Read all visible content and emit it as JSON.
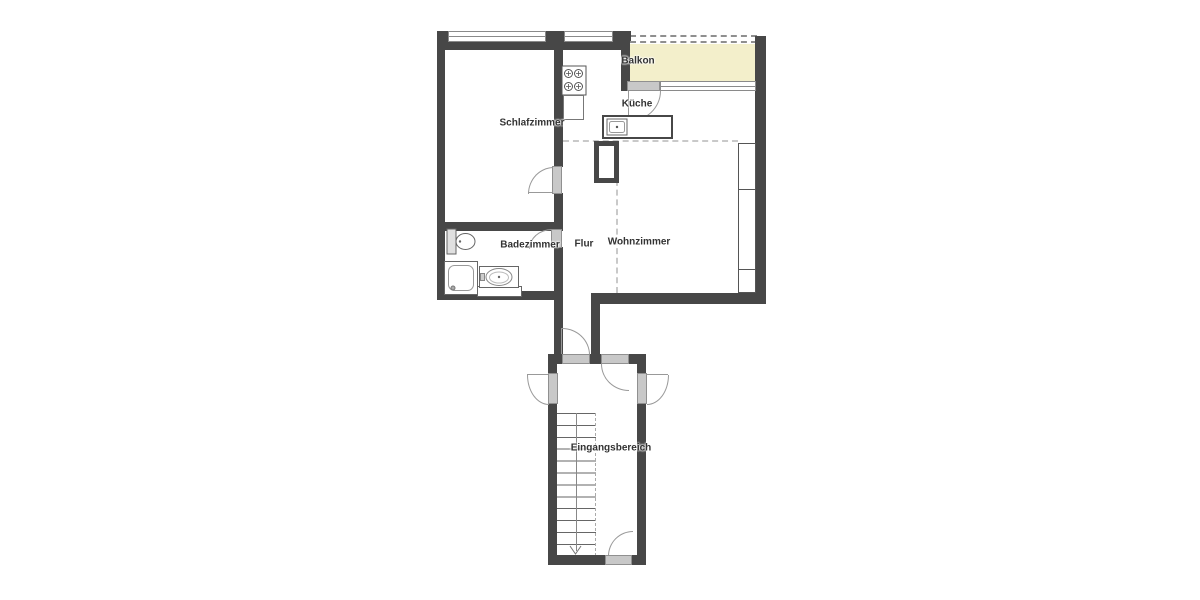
{
  "floorplan": {
    "rooms": {
      "balkon": "Balkon",
      "kueche": "Küche",
      "schlafzimmer": "Schlafzimmer",
      "badezimmer": "Badezimmer",
      "flur": "Flur",
      "wohnzimmer": "Wohnzimmer",
      "eingangsbereich": "Eingangsbereich"
    },
    "colors": {
      "wall": "#474747",
      "balcony_fill": "#f3efcb",
      "door_fill": "#c8c8c8",
      "swing_line": "#999999",
      "window_border": "#8a8a8a",
      "divider_dash": "#c9c9c9",
      "label_text": "#333333",
      "background": "#ffffff"
    },
    "icons": [
      "stove-icon",
      "kitchen-sink-icon",
      "toilet-icon",
      "shower-icon",
      "washbasin-icon",
      "stairs",
      "stair-direction-arrow",
      "door-swing-arc",
      "window",
      "balcony-railing"
    ]
  }
}
